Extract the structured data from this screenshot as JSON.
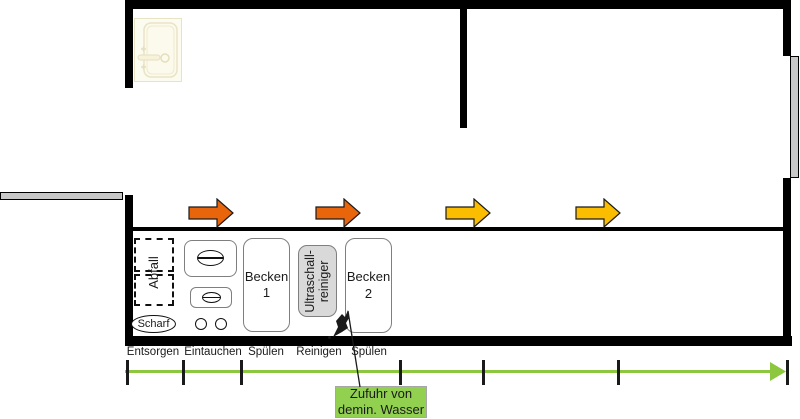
{
  "icons": {
    "sink": "sink-icon",
    "flow_arrow": "arrow-right-icon",
    "flow_arrowhead": "triangle-right-icon",
    "water_jet": "water-jet-icon",
    "dish": "dish-oval-icon",
    "door": "door-leaf"
  },
  "bench": {
    "waste_label": "Abfall",
    "sharp_label": "Scharf",
    "basin1_name": "Becken",
    "basin1_number": "1",
    "ultrasonic_line1": "Ultraschall-",
    "ultrasonic_line2": "reiniger",
    "basin2_name": "Becken",
    "basin2_number": "2"
  },
  "process_axis": {
    "steps": [
      "Entsorgen",
      "Eintauchen",
      "Spülen",
      "Reinigen",
      "Spülen"
    ]
  },
  "callout": {
    "line1": "Zufuhr von",
    "line2": "demin. Wasser"
  },
  "colors": {
    "arrow_orange": "#e8650c",
    "arrow_yellow": "#fbbd00",
    "flow_green": "#8dc63f",
    "callout_green": "#92d050",
    "equipment_gray": "#d9d9d9",
    "door_gray": "#c8c8c8",
    "wall": "#000000"
  }
}
